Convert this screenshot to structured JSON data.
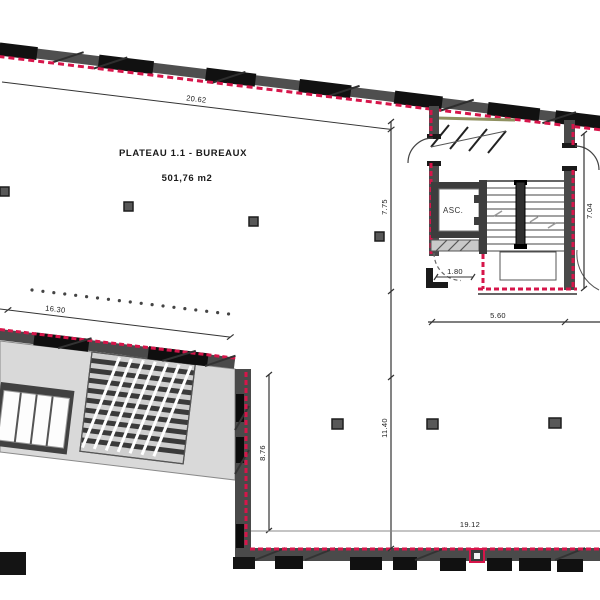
{
  "floor_plan": {
    "title": "PLATEAU 1.1 - BUREAUX",
    "area_label": "501,76 m2",
    "elevator_label": "ASC.",
    "dimensions": {
      "top_width": "20.62",
      "wing_top_width": "16.30",
      "core_height_left": "7.75",
      "core_height_right": "7.04",
      "core_width": "5.60",
      "door_clearance": "1.80",
      "lower_right_height": "11.40",
      "wing_side_height": "8.76",
      "bottom_width": "19.12"
    },
    "colors": {
      "wall_dark": "#4a4a4a",
      "window_black": "#111111",
      "demolition_red": "#d6154a",
      "block_fill": "#d9d9d9",
      "awning_olive": "#8f9060",
      "background": "#ffffff"
    }
  }
}
